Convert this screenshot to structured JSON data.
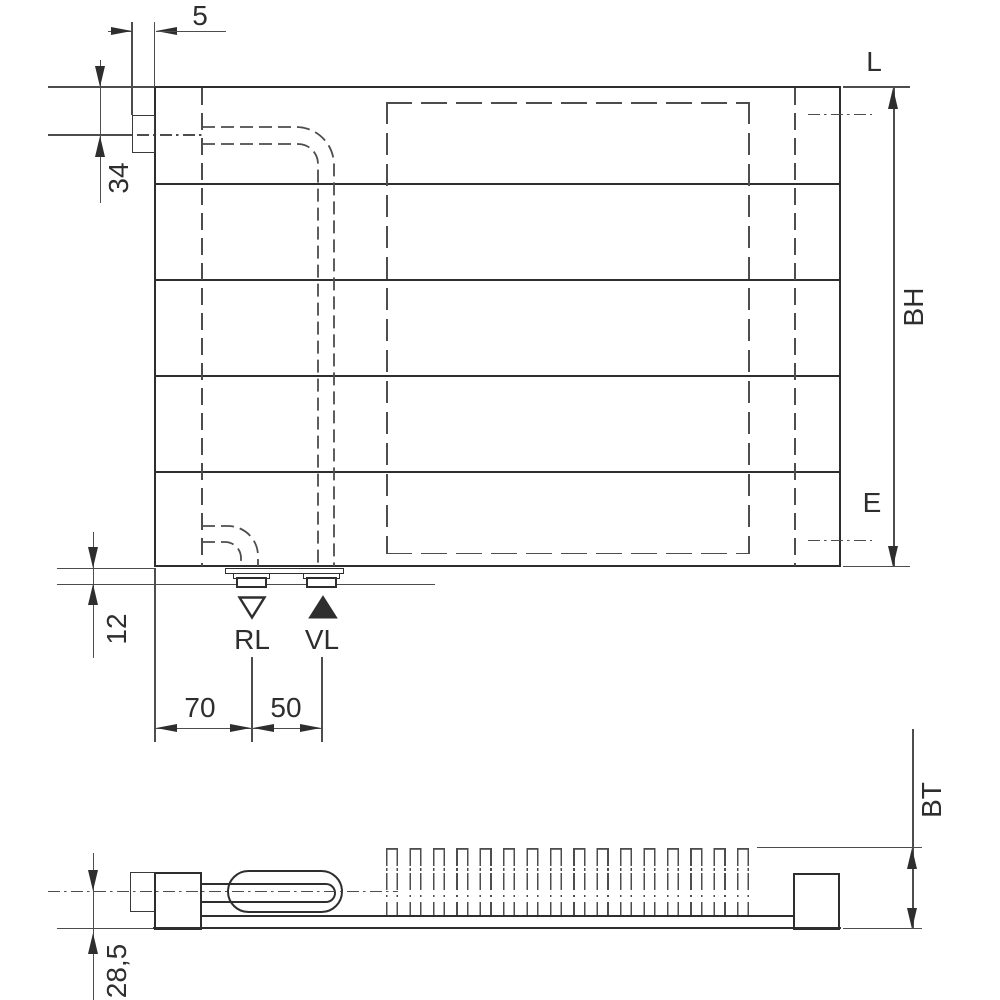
{
  "front_view": {
    "dims": {
      "bracket_offset": "5",
      "top_to_pipe_axis": "34",
      "bottom_to_connector": "12",
      "edge_to_return": "70",
      "return_to_supply": "50",
      "build_height": "BH"
    },
    "labels": {
      "length_ref": "L",
      "vent_ref": "E",
      "return_connection": "RL",
      "supply_connection": "VL"
    }
  },
  "side_view": {
    "dims": {
      "build_depth": "BT",
      "axis_to_back": "28,5"
    }
  },
  "icons": {
    "return_flow": "hollow-triangle-down",
    "supply_flow": "filled-triangle-up"
  },
  "colors": {
    "line": "#2e2e2e",
    "dim_line": "#4d4d4d",
    "background": "#ffffff"
  }
}
